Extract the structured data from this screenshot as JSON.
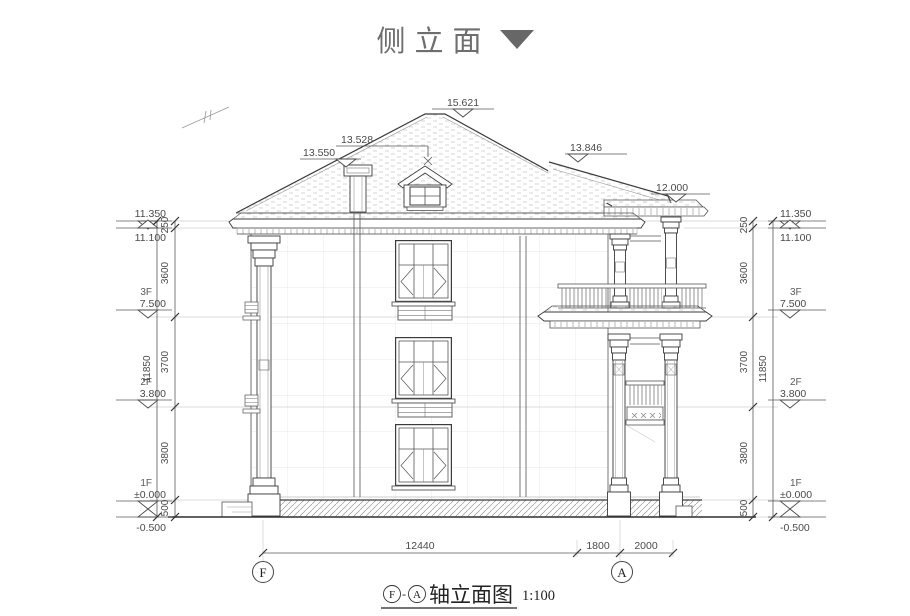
{
  "title": {
    "text": "侧立面"
  },
  "colors": {
    "line": "#3b3b3b",
    "dim": "#5a5a5a",
    "title_gray": "#6e6e6e",
    "texture": "#c6c6c6",
    "hatch": "#9a9a9a"
  },
  "markers": {
    "ridge": "15.621",
    "chimney": "13.550",
    "dormer": "13.528",
    "wing_roof": "13.846",
    "porch_roof": "12.000",
    "left": {
      "parapet": "11.350",
      "eave": "11.100",
      "f3_label": "3F",
      "f3": "7.500",
      "f2_label": "2F",
      "f2": "3.800",
      "f1_label": "1F",
      "f1": "±0.000",
      "ground": "-0.500"
    },
    "right": {
      "parapet": "11.350",
      "eave": "11.100",
      "f3_label": "3F",
      "f3": "7.500",
      "f2_label": "2F",
      "f2": "3.800",
      "f1_label": "1F",
      "f1": "±0.000",
      "ground": "-0.500"
    }
  },
  "dims": {
    "left": {
      "d250": "250",
      "d3600": "3600",
      "d3700": "3700",
      "d3800": "3800",
      "d500": "500",
      "overall": "11850"
    },
    "right": {
      "d250": "250",
      "d3600": "3600",
      "d3700": "3700",
      "d3800": "3800",
      "d500": "500",
      "overall": "11850"
    },
    "bottom": {
      "d1": "12440",
      "d2": "1800",
      "d3": "2000"
    }
  },
  "axes": {
    "f": "F",
    "a": "A"
  },
  "caption": {
    "f": "F",
    "separator": "-",
    "a": "A",
    "text": "轴立面图",
    "scale": "1:100"
  }
}
